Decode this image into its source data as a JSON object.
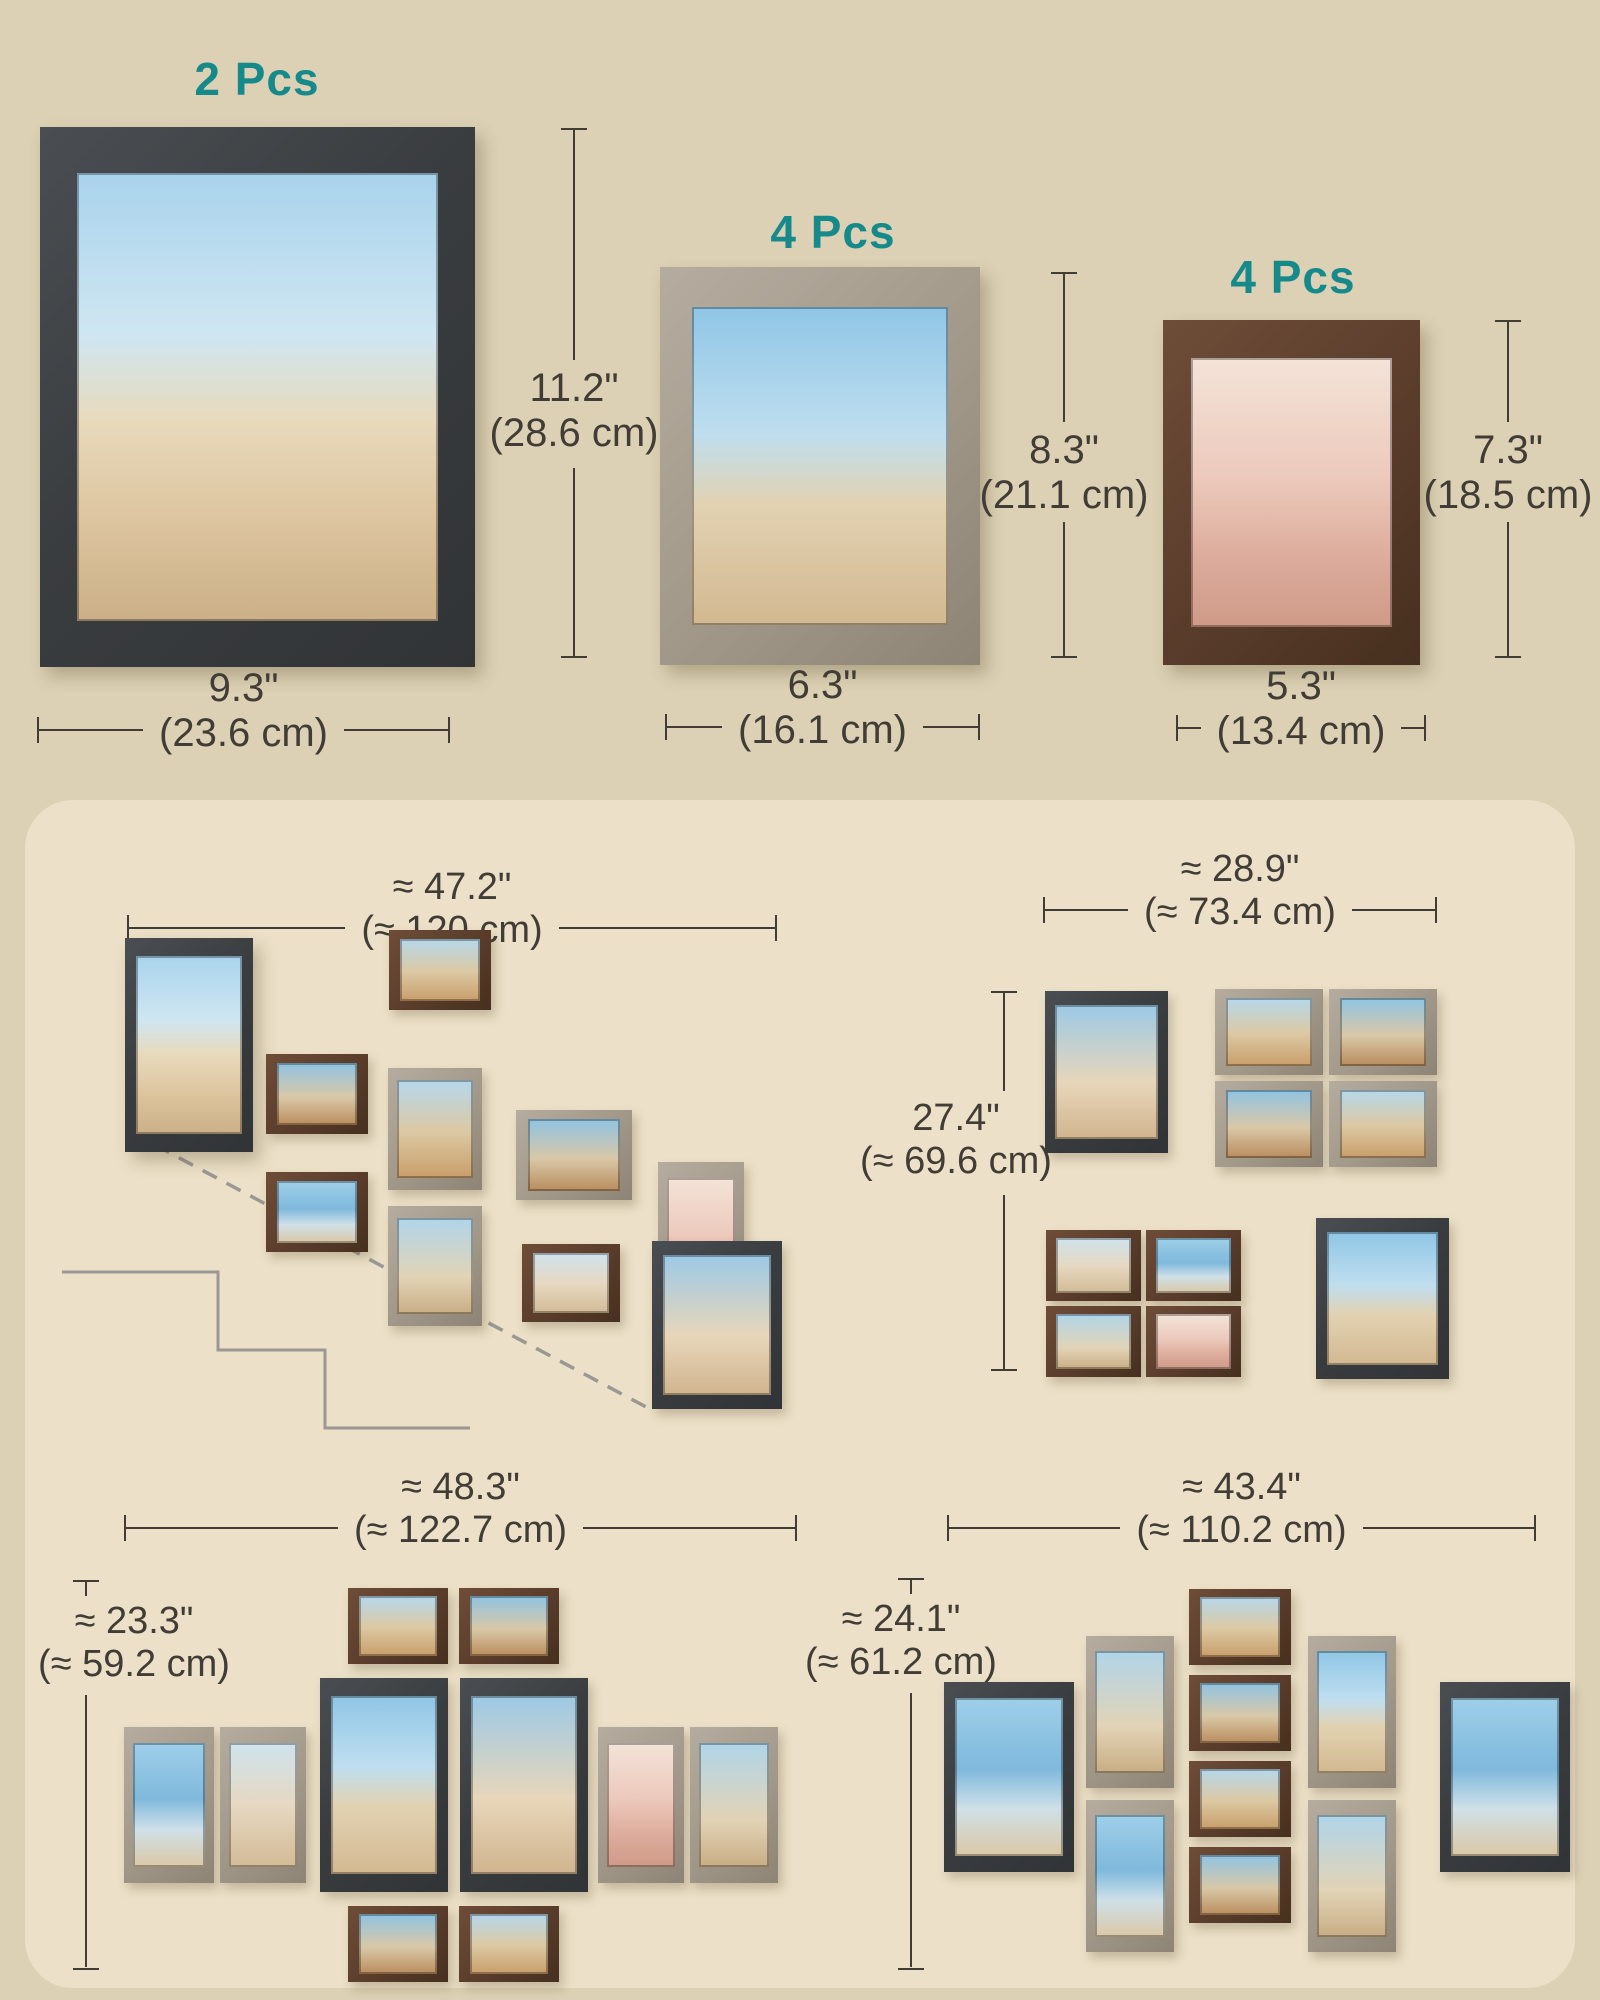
{
  "page": {
    "background": "#DCD1B4",
    "panel_background": "#ECE1C8",
    "accent_teal": "#16898B",
    "dimension_text_color": "#413C35"
  },
  "products": [
    {
      "qty_label": "2 Pcs",
      "height_in": "11.2\"",
      "height_cm": "(28.6 cm)",
      "width_in": "9.3\"",
      "width_cm": "(23.6 cm)",
      "frame_color": "black"
    },
    {
      "qty_label": "4 Pcs",
      "height_in": "8.3\"",
      "height_cm": "(21.1 cm)",
      "width_in": "6.3\"",
      "width_cm": "(16.1 cm)",
      "frame_color": "gray"
    },
    {
      "qty_label": "4 Pcs",
      "height_in": "7.3\"",
      "height_cm": "(18.5 cm)",
      "width_in": "5.3\"",
      "width_cm": "(13.4 cm)",
      "frame_color": "brown"
    }
  ],
  "layouts": {
    "staircase": {
      "width_in": "≈ 47.2\"",
      "width_cm": "(≈ 120 cm)"
    },
    "grid": {
      "width_in": "≈ 28.9\"",
      "width_cm": "(≈ 73.4 cm)",
      "height_in": "27.4\"",
      "height_cm": "(≈ 69.6 cm)"
    },
    "symmetric": {
      "width_in": "≈ 48.3\"",
      "width_cm": "(≈ 122.7 cm)",
      "height_in": "≈ 23.3\"",
      "height_cm": "(≈ 59.2 cm)"
    },
    "diamond": {
      "width_in": "≈ 43.4\"",
      "width_cm": "(≈ 110.2 cm)",
      "height_in": "≈ 24.1\"",
      "height_cm": "(≈ 61.2 cm)"
    }
  }
}
